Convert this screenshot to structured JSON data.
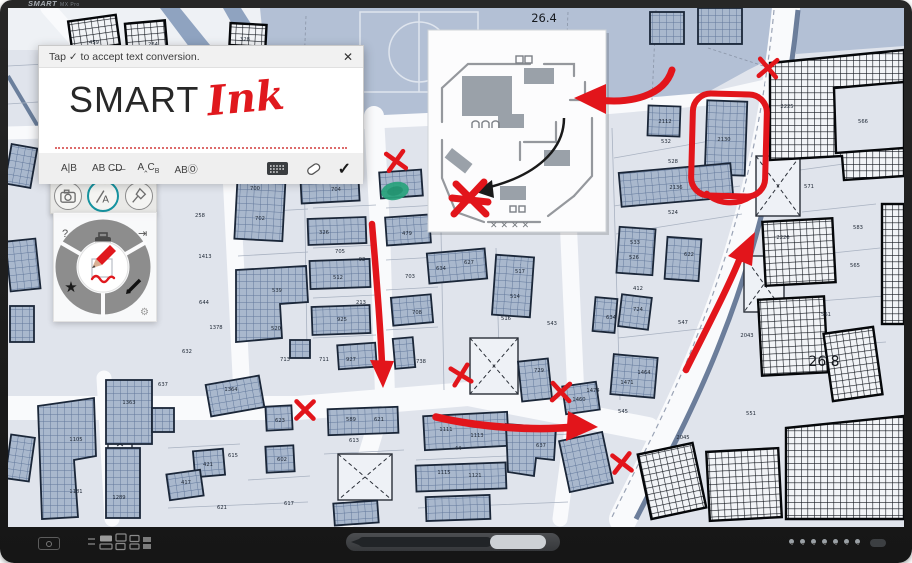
{
  "bezel": {
    "logo": "SMART",
    "logo_suffix": "MX Pro"
  },
  "ink_dialog": {
    "header": "Tap ✓ to accept text conversion.",
    "close": "✕",
    "converted_text": "SMART",
    "handwritten_text": "Ink",
    "gestures": [
      {
        "name": "insert-space",
        "label": "A|B"
      },
      {
        "name": "delete-strike",
        "label": "AB C̶D̶"
      },
      {
        "name": "insert-word",
        "label": "A‸C",
        "sub": "B"
      },
      {
        "name": "select-circle",
        "label": "ABⓄ"
      }
    ],
    "accept": "✓"
  },
  "floating_toolbar": {
    "tools": [
      {
        "name": "screen-capture",
        "selected": false
      },
      {
        "name": "convert-ink-to-text",
        "selected": true
      },
      {
        "name": "spotlight",
        "selected": false
      }
    ],
    "selected_color": "#1593a0"
  },
  "radial_widget": {
    "help": "?",
    "dock": "⇥",
    "settings_gear": "⚙",
    "favorites_star": "★",
    "active_tool": "red-pen"
  },
  "map": {
    "area_labels": [
      {
        "t": "26.4",
        "x": 536,
        "y": 14,
        "s": 11.5
      },
      {
        "t": "26.8",
        "x": 816,
        "y": 358,
        "s": 14
      }
    ],
    "parcel_labels": [
      {
        "t": "459",
        "x": 86,
        "y": 36
      },
      {
        "t": "264",
        "x": 145,
        "y": 38
      },
      {
        "t": "328",
        "x": 237,
        "y": 33
      },
      {
        "t": "258",
        "x": 192,
        "y": 209
      },
      {
        "t": "1413",
        "x": 197,
        "y": 250
      },
      {
        "t": "644",
        "x": 196,
        "y": 296
      },
      {
        "t": "1378",
        "x": 208,
        "y": 321
      },
      {
        "t": "632",
        "x": 179,
        "y": 345
      },
      {
        "t": "700",
        "x": 247,
        "y": 182
      },
      {
        "t": "702",
        "x": 252,
        "y": 212
      },
      {
        "t": "539",
        "x": 269,
        "y": 284
      },
      {
        "t": "520",
        "x": 268,
        "y": 322
      },
      {
        "t": "713",
        "x": 277,
        "y": 353
      },
      {
        "t": "704",
        "x": 328,
        "y": 183
      },
      {
        "t": "326",
        "x": 316,
        "y": 226
      },
      {
        "t": "705",
        "x": 332,
        "y": 245
      },
      {
        "t": "92",
        "x": 354,
        "y": 253
      },
      {
        "t": "512",
        "x": 330,
        "y": 271
      },
      {
        "t": "213",
        "x": 353,
        "y": 296
      },
      {
        "t": "925",
        "x": 334,
        "y": 313
      },
      {
        "t": "711",
        "x": 316,
        "y": 353
      },
      {
        "t": "927",
        "x": 343,
        "y": 353
      },
      {
        "t": "479",
        "x": 399,
        "y": 227
      },
      {
        "t": "703",
        "x": 402,
        "y": 270
      },
      {
        "t": "708",
        "x": 409,
        "y": 306
      },
      {
        "t": "738",
        "x": 413,
        "y": 355
      },
      {
        "t": "627",
        "x": 461,
        "y": 256
      },
      {
        "t": "634",
        "x": 433,
        "y": 262
      },
      {
        "t": "517",
        "x": 512,
        "y": 265
      },
      {
        "t": "514",
        "x": 507,
        "y": 290
      },
      {
        "t": "516",
        "x": 498,
        "y": 312
      },
      {
        "t": "543",
        "x": 544,
        "y": 317
      },
      {
        "t": "2112",
        "x": 657,
        "y": 115
      },
      {
        "t": "532",
        "x": 658,
        "y": 135
      },
      {
        "t": "2130",
        "x": 716,
        "y": 133
      },
      {
        "t": "528",
        "x": 665,
        "y": 155
      },
      {
        "t": "2136",
        "x": 668,
        "y": 181
      },
      {
        "t": "524",
        "x": 665,
        "y": 206
      },
      {
        "t": "533",
        "x": 627,
        "y": 236
      },
      {
        "t": "526",
        "x": 626,
        "y": 251
      },
      {
        "t": "622",
        "x": 681,
        "y": 248
      },
      {
        "t": "412",
        "x": 630,
        "y": 282
      },
      {
        "t": "724",
        "x": 630,
        "y": 303
      },
      {
        "t": "634",
        "x": 603,
        "y": 311
      },
      {
        "t": "547",
        "x": 675,
        "y": 316
      },
      {
        "t": "1464",
        "x": 636,
        "y": 366
      },
      {
        "t": "1471",
        "x": 619,
        "y": 376
      },
      {
        "t": "1474",
        "x": 585,
        "y": 384
      },
      {
        "t": "1460",
        "x": 571,
        "y": 393
      },
      {
        "t": "545",
        "x": 615,
        "y": 405
      },
      {
        "t": "566",
        "x": 855,
        "y": 115
      },
      {
        "t": "2225",
        "x": 779,
        "y": 100
      },
      {
        "t": "571",
        "x": 801,
        "y": 180
      },
      {
        "t": "583",
        "x": 850,
        "y": 221
      },
      {
        "t": "565",
        "x": 847,
        "y": 259
      },
      {
        "t": "2226",
        "x": 775,
        "y": 231
      },
      {
        "t": "561",
        "x": 818,
        "y": 308
      },
      {
        "t": "2043",
        "x": 739,
        "y": 329
      },
      {
        "t": "551",
        "x": 743,
        "y": 407
      },
      {
        "t": "2045",
        "x": 675,
        "y": 431
      },
      {
        "t": "589",
        "x": 343,
        "y": 413
      },
      {
        "t": "621",
        "x": 371,
        "y": 413
      },
      {
        "t": "613",
        "x": 346,
        "y": 434
      },
      {
        "t": "1111",
        "x": 438,
        "y": 423
      },
      {
        "t": "1113",
        "x": 469,
        "y": 429
      },
      {
        "t": "44",
        "x": 450,
        "y": 442
      },
      {
        "t": "637",
        "x": 533,
        "y": 439
      },
      {
        "t": "729",
        "x": 531,
        "y": 364
      },
      {
        "t": "1105",
        "x": 68,
        "y": 433
      },
      {
        "t": "1181",
        "x": 68,
        "y": 485
      },
      {
        "t": "1289",
        "x": 111,
        "y": 491
      },
      {
        "t": "1363",
        "x": 121,
        "y": 396
      },
      {
        "t": "637",
        "x": 155,
        "y": 378
      },
      {
        "t": "1364",
        "x": 223,
        "y": 383
      },
      {
        "t": "421",
        "x": 200,
        "y": 458
      },
      {
        "t": "417",
        "x": 178,
        "y": 476
      },
      {
        "t": "615",
        "x": 225,
        "y": 449
      },
      {
        "t": "621",
        "x": 214,
        "y": 501
      },
      {
        "t": "617",
        "x": 281,
        "y": 497
      },
      {
        "t": "623",
        "x": 272,
        "y": 414
      },
      {
        "t": "602",
        "x": 274,
        "y": 453
      },
      {
        "t": "1115",
        "x": 436,
        "y": 466
      },
      {
        "t": "1121",
        "x": 467,
        "y": 469
      }
    ]
  },
  "annotations": {
    "ink_color": "#e2151b",
    "highlight_color": "#28a27c",
    "circled_parcel": "2130",
    "x_marks": [
      {
        "x": 760,
        "y": 60,
        "r": 8
      },
      {
        "x": 388,
        "y": 153,
        "r": -6
      },
      {
        "x": 297,
        "y": 402,
        "r": 4
      },
      {
        "x": 453,
        "y": 367,
        "r": -10
      },
      {
        "x": 553,
        "y": 384,
        "r": 6
      },
      {
        "x": 614,
        "y": 455,
        "r": -4
      }
    ],
    "arrows": [
      {
        "name": "arrow-down-road"
      },
      {
        "name": "arrow-right-road"
      },
      {
        "name": "arrow-up-main-road"
      },
      {
        "name": "arrow-into-floor-plan"
      }
    ],
    "inset_xxxx": "✕✕✕✕"
  }
}
